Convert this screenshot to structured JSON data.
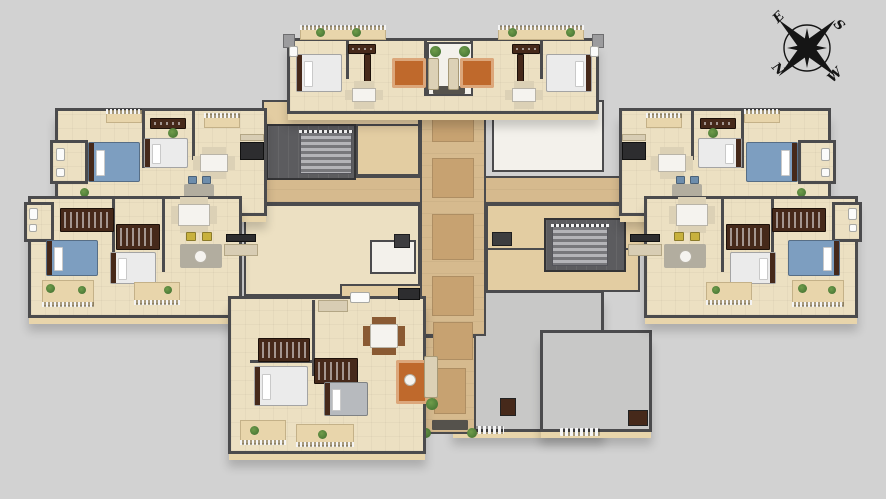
{
  "compass": {
    "north": "N",
    "east": "E",
    "south": "S",
    "west": "W"
  },
  "colors": {
    "bg": "#d2d2d2",
    "floor": "#ece0c2",
    "floor-warm": "#e3cda2",
    "wall": "#4b4b4d",
    "wallface": "#e8d5ab",
    "corridor": "#d6ba8e",
    "runner": "#c7a271",
    "terrace": "#c8c8c7",
    "white-room": "#f3f1eb",
    "rug-orange": "#bf692c",
    "rug-gray": "#b2ad9f",
    "bed-blue": "#7d9ec0",
    "bed-gray": "#b7babe",
    "bed-white": "#ebebeb",
    "wood-dark": "#46291a",
    "wood": "#8a5a33",
    "sofa": "#dcd1b6",
    "chair-yellow": "#c8b13d",
    "chair-blue": "#6d8dac",
    "table-white": "#f5f3ef",
    "plant": "#4c7a37",
    "plant-light": "#6f9c4a",
    "stair": "#8e8e91",
    "stairwell": "#5c5c5f",
    "railing": "#f4f4f4",
    "elevator": "#3d3d3f",
    "counter-dark": "#2d2d2f",
    "mat-dark": "#55524c",
    "compass-ink": "#151515"
  }
}
